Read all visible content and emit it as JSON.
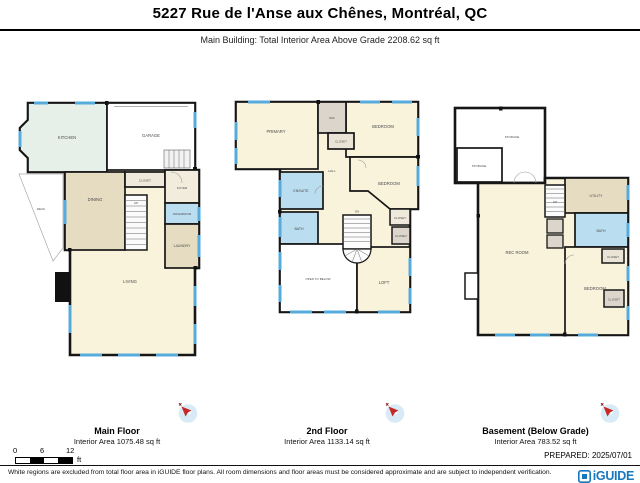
{
  "header": {
    "title": "5227 Rue de l'Anse aux Chênes, Montréal, QC",
    "subtitle": "Main Building: Total Interior Area Above Grade 2208.62 sq ft"
  },
  "plans": {
    "main": {
      "label": "Main Floor",
      "area": "Interior Area 1075.48 sq ft",
      "rooms": {
        "kitchen": "KITCHEN",
        "garage": "GARAGE",
        "deck": "DECK",
        "dining": "DINING",
        "closet": "CLOSET",
        "foyer": "FOYER",
        "washroom": "WASHROOM",
        "laundry": "LAUNDRY",
        "living": "LIVING",
        "up": "UP"
      }
    },
    "second": {
      "label": "2nd Floor",
      "area": "Interior Area 1133.14 sq ft",
      "rooms": {
        "primary": "PRIMARY",
        "wic": "WIC",
        "closet_top": "CLOSET",
        "bedroom2": "BEDROOM",
        "bedroom3": "BEDROOM",
        "ensuite": "ENSUITE",
        "bath": "BATH",
        "hall": "HALL",
        "dn": "DN",
        "closet_r1": "CLOSET",
        "closet_r2": "CLOSET",
        "open_to_below": "OPEN TO BELOW",
        "loft": "LOFT"
      }
    },
    "basement": {
      "label": "Basement (Below Grade)",
      "area": "Interior Area 783.52 sq ft",
      "rooms": {
        "storage1": "STORAGE",
        "storage2": "STORAGE",
        "rec": "REC ROOM",
        "up": "UP",
        "utility": "UTILITY",
        "bath": "BATH",
        "bedroom": "BEDROOM",
        "closet1": "CLOSET",
        "closet2": "CLOSET"
      }
    }
  },
  "scale": {
    "ticks": [
      "0",
      "6",
      "12"
    ],
    "unit": "ft"
  },
  "footer": {
    "prepared": "PREPARED: 2025/07/01",
    "disclaimer": "White regions are excluded from total floor area in iGUIDE floor plans. All room dimensions and floor areas must be considered approximate and are subject to independent verification.",
    "brand": "iGUIDE"
  },
  "colors": {
    "window_blue": "#56ABDC",
    "bathroom_blue": "#BADDF0",
    "wood_tan": "#E6DCC2",
    "floor_cream": "#FAF3DB",
    "kitchen_mint": "#E7F0E8",
    "closet_gray": "#DBD5CB",
    "wall_black": "#161616",
    "brand_blue": "#1878BE"
  }
}
